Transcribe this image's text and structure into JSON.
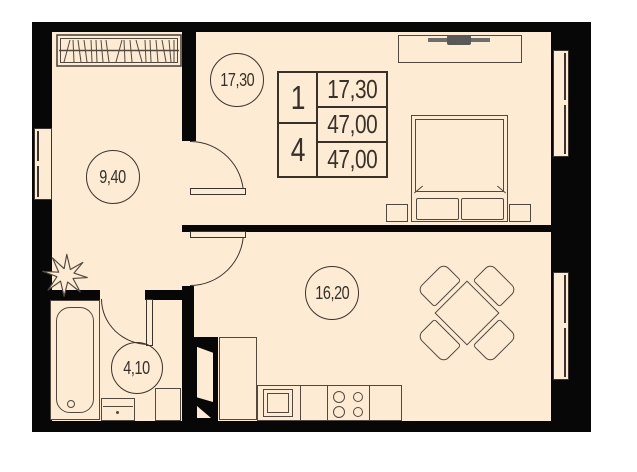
{
  "title": "Apartment floor plan, 1 room, 47.00 sq.m",
  "colors": {
    "floor": "#fdecd3",
    "wall": "#070707",
    "line": "#51493f",
    "line_dark": "#3a342c",
    "text": "#37312a"
  },
  "rooms": [
    {
      "id": "bedroom",
      "area": "17,30"
    },
    {
      "id": "hallway",
      "area": "9,40"
    },
    {
      "id": "living_kitchen",
      "area": "16,20"
    },
    {
      "id": "bathroom",
      "area": "4,10"
    }
  ],
  "info_table": {
    "left": [
      "1",
      "4"
    ],
    "right": [
      "17,30",
      "47,00",
      "47,00"
    ]
  },
  "icons": {
    "wardrobe": "hanger-rail-hatch",
    "plant": "spiky-leaf-star",
    "bathtub": "rounded-tub",
    "stove": "four-burners",
    "tv": "flat-screen-bar"
  }
}
